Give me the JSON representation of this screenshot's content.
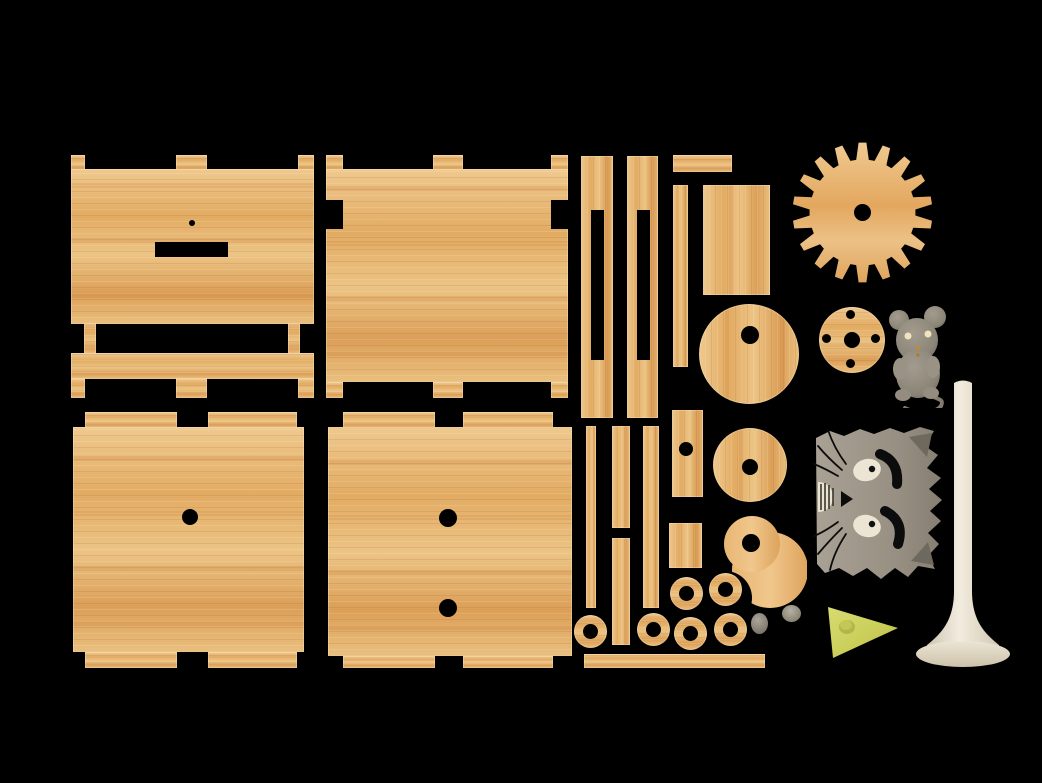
{
  "scene": {
    "description": "Flat-lay product render of a laser-cut wooden cat automaton kit: plywood panels, struts, gear, discs and washers, with gray mouse and cat-face figures, a cheese wedge, two pebbles and a cream pedestal stand on a black background",
    "background": "#000000"
  },
  "colors": {
    "background": "#000000",
    "wood-light": "#efc98f",
    "wood-mid": "#e5b26b",
    "wood-deep": "#db9f58",
    "plastic-gray": "#968f82",
    "plastic-gray-dark": "#6e695e",
    "cream": "#eee8d8",
    "cheese": "#ccd05e",
    "cheese-dark": "#aeb348"
  },
  "gear": {
    "teeth": 18,
    "center_hole": true
  },
  "parts_inventory": {
    "panels": [
      {
        "name": "front-panel",
        "features": "3 edge tabs top and bottom, pin hole, rectangular slot, window opening"
      },
      {
        "name": "back-panel",
        "features": "3 edge tabs top and bottom, side notches"
      },
      {
        "name": "side-panel-one-hole",
        "features": "2 wide tabs top and bottom, 1 axle hole"
      },
      {
        "name": "side-panel-two-holes",
        "features": "2 wide tabs top and bottom, 2 axle holes"
      }
    ],
    "struts": {
      "slotted_struts": 2,
      "plain_struts": 4,
      "short_bars": 2,
      "small_plates_with_hole": 1,
      "small_plates": 1,
      "long_thin_rail": 1
    },
    "round_parts": {
      "gear_wheel": 1,
      "large_disc_offset_hole": 1,
      "medium_disc_center_hole": 1,
      "cam_comma_disc": 1,
      "flange_disc_5_holes": 1,
      "washers": 6
    },
    "figures": {
      "mouse": 1,
      "cat-face": 1,
      "cheese-wedge": 1,
      "pebbles": 2,
      "pedestal-stand": 1
    }
  }
}
